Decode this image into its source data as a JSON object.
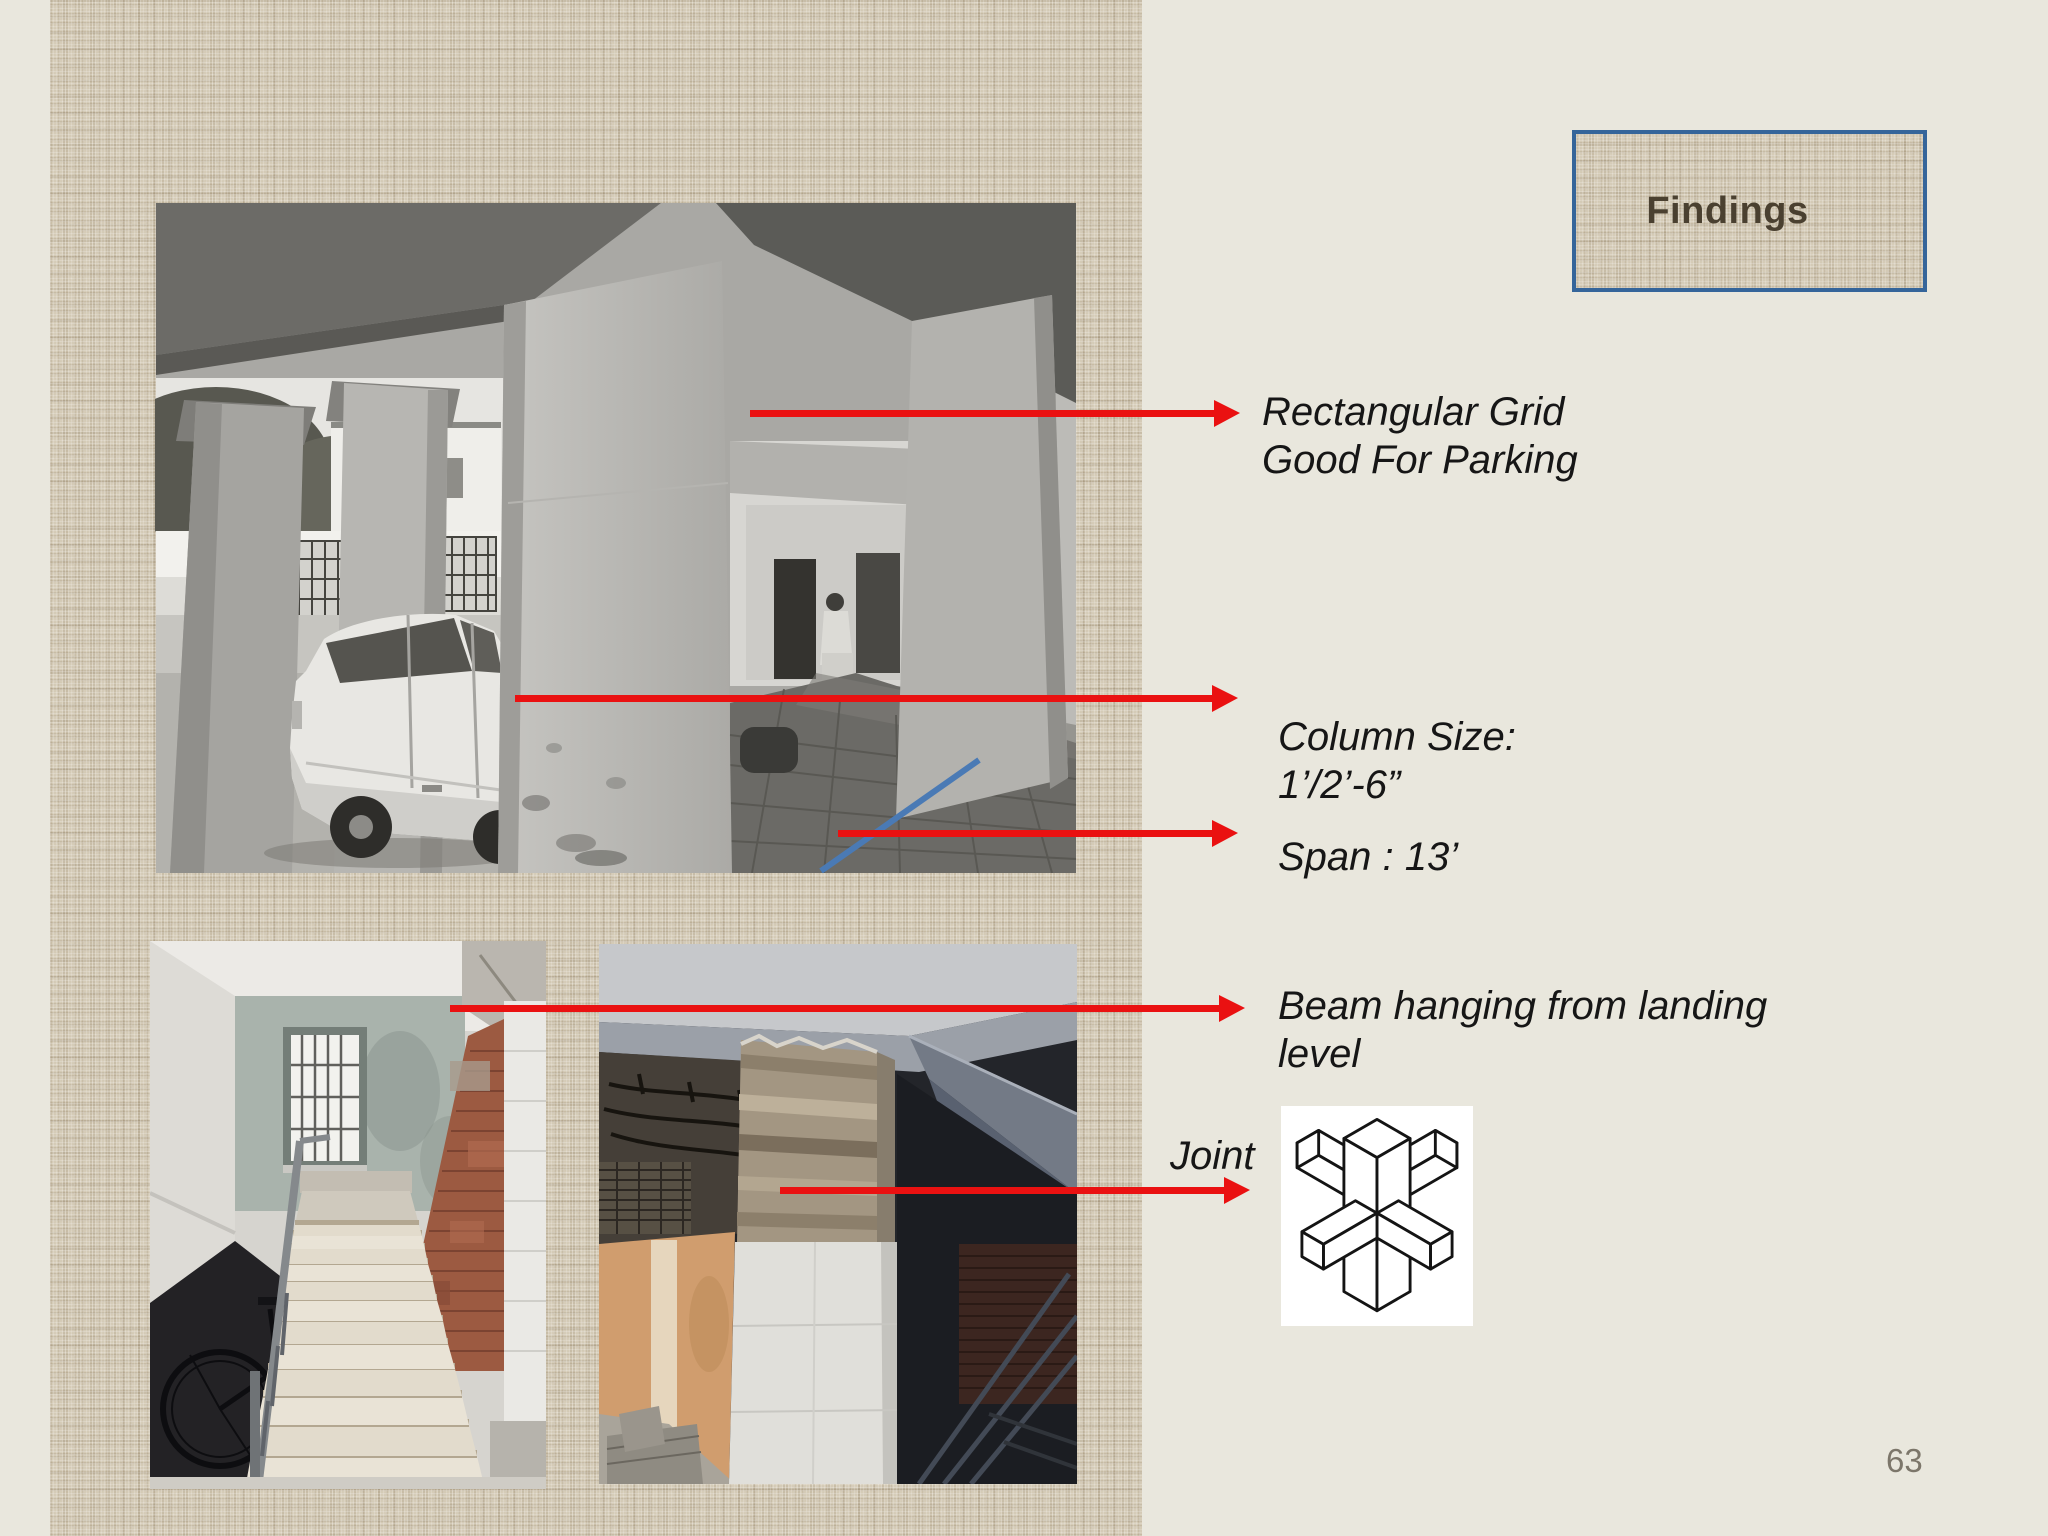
{
  "slide": {
    "page_number": "63",
    "title_box": {
      "label": "Findings"
    },
    "annotations": {
      "rect_grid_line1": "Rectangular Grid",
      "rect_grid_line2": "Good For Parking",
      "column_size_line1": "Column Size:",
      "column_size_line2": "1’/2’-6”",
      "span": "Span : 13’",
      "beam_line1": "Beam hanging from landing",
      "beam_line2": "level",
      "joint": "Joint"
    },
    "colors": {
      "background": "#e9e7dd",
      "panel_linen": "#d9d0bd",
      "arrow_red": "#ea1111",
      "title_border_blue": "#35659a",
      "title_text": "#4a4030",
      "annotation_text": "#161616",
      "page_number_gray": "#7c766a"
    }
  }
}
